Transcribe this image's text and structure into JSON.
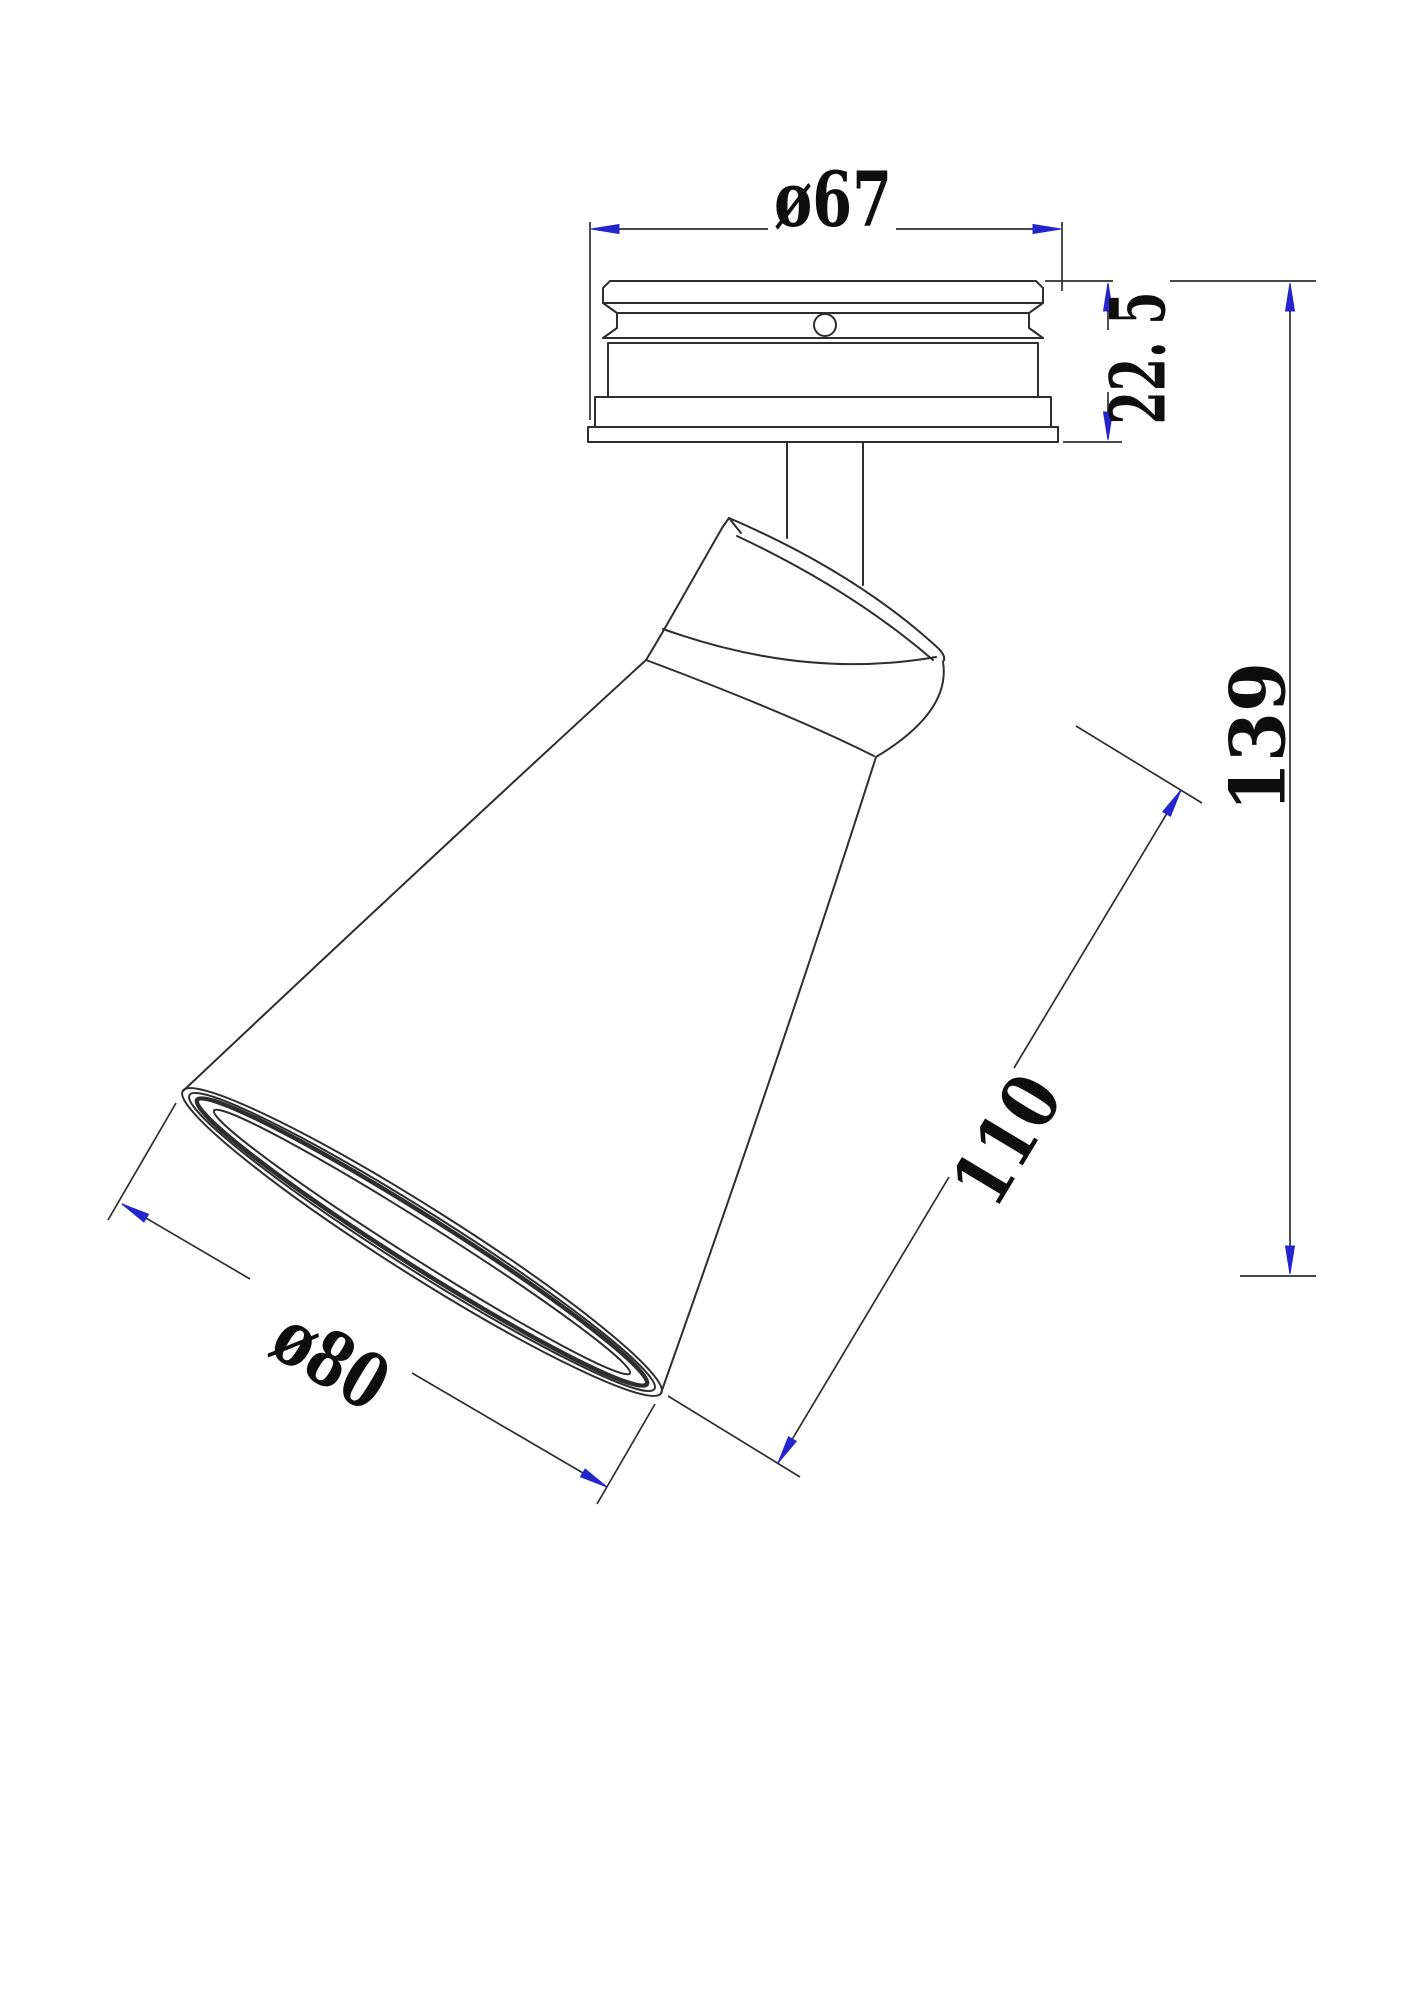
{
  "drawing": {
    "colors": {
      "line": "#2e2e2e",
      "accent": "#2525cd",
      "text": "#0e0e0e",
      "background": "#ffffff"
    },
    "dimensions": {
      "canopy_diameter": {
        "label": "ø67"
      },
      "canopy_height": {
        "label": "22. 5"
      },
      "overall_height": {
        "label": "139"
      },
      "head_length": {
        "label": "110"
      },
      "shade_opening_diameter": {
        "label": "ø80"
      }
    }
  }
}
